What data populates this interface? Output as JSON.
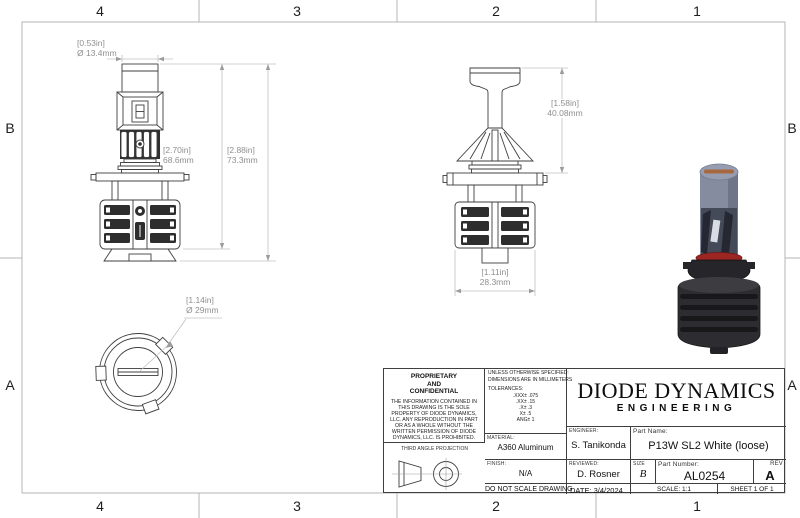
{
  "sheet": {
    "zone_cols": [
      "4",
      "3",
      "2",
      "1"
    ],
    "zone_rows": [
      "B",
      "A"
    ]
  },
  "dimensions": {
    "tube_diameter": {
      "inches": "[0.53in]",
      "mm": "Ø 13.4mm"
    },
    "body_height": {
      "inches": "[2.70in]",
      "mm": "68.6mm"
    },
    "overall_height": {
      "inches": "[2.88in]",
      "mm": "73.3mm"
    },
    "upper_section_height": {
      "inches": "[1.58in]",
      "mm": "40.08mm"
    },
    "heatsink_width": {
      "inches": "[1.11in]",
      "mm": "28.3mm"
    },
    "base_diameter": {
      "inches": "[1.14in]",
      "mm": "Ø 29mm"
    }
  },
  "title_block": {
    "proprietary_title_1": "PROPRIETARY",
    "proprietary_title_2": "AND",
    "proprietary_title_3": "CONFIDENTIAL",
    "proprietary_body": "THE INFORMATION CONTAINED IN THIS DRAWING IS THE SOLE PROPERTY OF DIODE DYNAMICS, LLC.  ANY REPRODUCTION IN PART OR AS A WHOLE WITHOUT THE WRITTEN PERMISSION OF DIODE DYNAMICS, LLC. IS PROHIBITED.",
    "projection_label": "THIRD ANGLE PROJECTION",
    "spec_note_1": "UNLESS OTHERWISE SPECIFIED:",
    "spec_note_2": "DIMENSIONS ARE IN MILLIMETERS",
    "tolerances_label": "TOLERANCES:",
    "tolerances": [
      ".XXX± .075",
      ".XX± .15",
      ".X± .3",
      "X± .5",
      "ANG± 1"
    ],
    "material_label": "MATERIAL:",
    "material": "A360 Aluminum",
    "finish_label": "FINISH:",
    "finish": "N/A",
    "do_not_scale": "DO NOT SCALE DRAWING",
    "logo_line1": "DIODE DYNAMICS",
    "logo_line2": "ENGINEERING",
    "engineer_label": "ENGINEER:",
    "engineer": "S. Tanikonda",
    "part_name_label": "Part Name:",
    "part_name": "P13W SL2 White (loose)",
    "reviewed_label": "REVIEWED:",
    "reviewed": "D. Rosner",
    "size_label": "SIZE",
    "size": "B",
    "part_number_label": "Part Number:",
    "part_number": "AL0254",
    "rev_label": "REV",
    "rev": "A",
    "date_label": "DATE:",
    "date": "3/4/2024",
    "scale": "SCALE: 1:1",
    "sheet": "SHEET 1 OF 1"
  }
}
